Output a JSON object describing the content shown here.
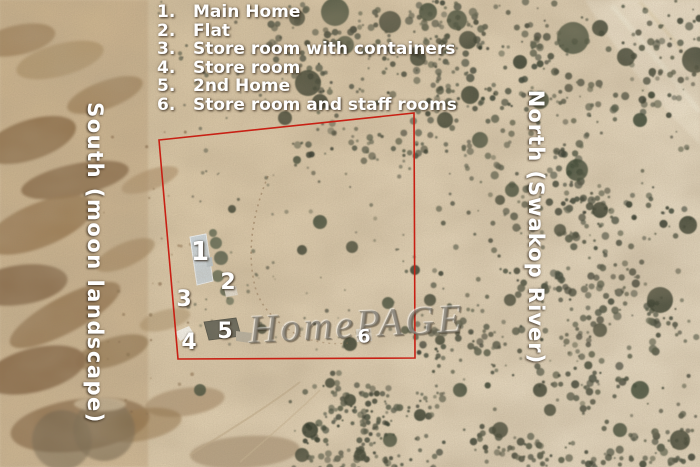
{
  "legend": {
    "items": [
      {
        "num": "1.",
        "label": "Main Home"
      },
      {
        "num": "2.",
        "label": "Flat"
      },
      {
        "num": "3.",
        "label": "Store room with containers"
      },
      {
        "num": "4.",
        "label": "Store room"
      },
      {
        "num": "5.",
        "label": "2nd Home"
      },
      {
        "num": "6.",
        "label": "Store room and staff rooms"
      }
    ]
  },
  "side_labels": {
    "left": "South (moon landscape)",
    "right": "North (Swakop River)"
  },
  "watermark": "HomePAGE",
  "boundary": {
    "color": "#c8201424",
    "stroke": "#c82014",
    "points": "159,140 414,113 415,358 178,359"
  },
  "markers": [
    {
      "n": "1",
      "x": 200,
      "y": 252,
      "size": 26
    },
    {
      "n": "2",
      "x": 228,
      "y": 283,
      "size": 22
    },
    {
      "n": "3",
      "x": 184,
      "y": 300,
      "size": 22
    },
    {
      "n": "4",
      "x": 189,
      "y": 343,
      "size": 22
    },
    {
      "n": "5",
      "x": 225,
      "y": 332,
      "size": 22
    },
    {
      "n": "6",
      "x": 364,
      "y": 337,
      "size": 19
    }
  ],
  "colors": {
    "sand": "#d9c7a8",
    "rock_brown": "#8a6a45",
    "vegetation_dark": "#3a4233",
    "boundary_red": "#c82014",
    "annotation_text": "#ffffff",
    "watermark_gray": "#706a5f",
    "main_home_roof": "#ccd6dc"
  }
}
